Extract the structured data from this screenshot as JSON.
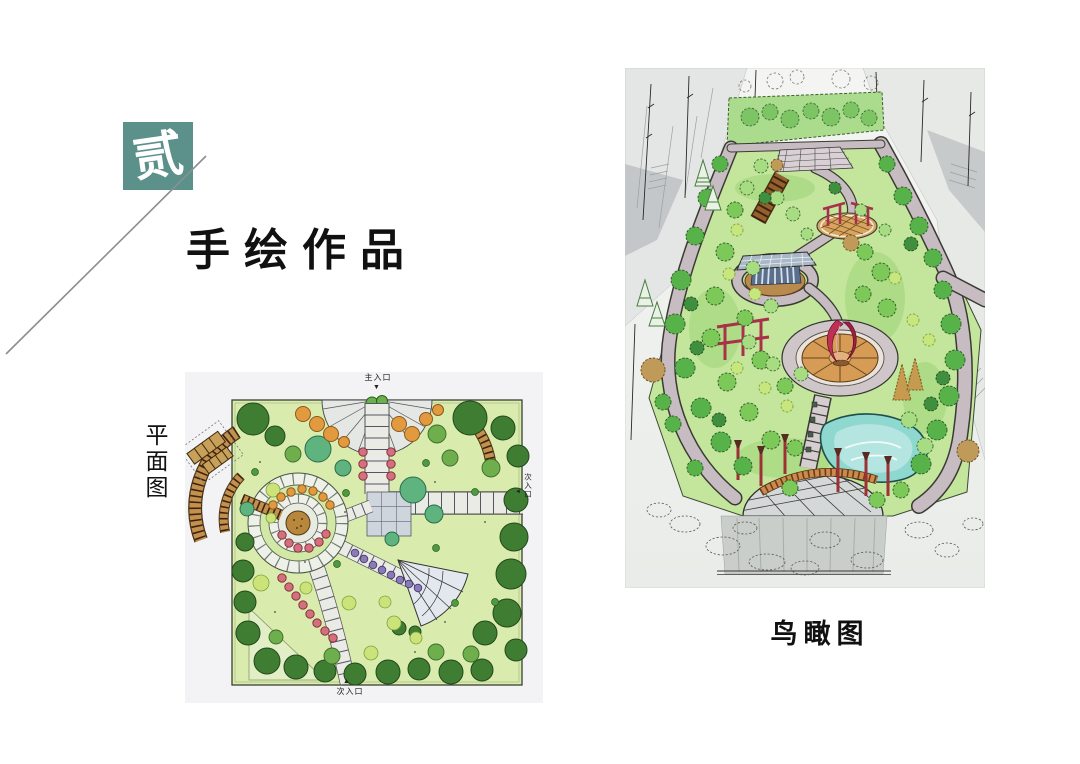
{
  "slide": {
    "background": "#ffffff"
  },
  "badge": {
    "number_char": "贰",
    "bg_color": "#5b918a",
    "fg_color": "#ffffff"
  },
  "divider": {
    "color": "#8a8f8f"
  },
  "title": {
    "text": "手绘作品",
    "color": "#111111"
  },
  "plan": {
    "caption": "平面图",
    "entrance_labels": {
      "main": "主入口",
      "right": "次入口",
      "bottom": "次入口"
    },
    "arrows": {
      "down": "▼",
      "left": "◄",
      "up": "▲"
    },
    "palette": {
      "paper": "#f3f3f5",
      "lawn": "#d9ecae",
      "tree_dark": "#3f7d33",
      "tree_teal": "#5fb37f",
      "shrub_orange": "#e39a3f",
      "shrub_pink": "#d4707e",
      "shrub_purple": "#8a7ab8",
      "path": "#e9ebe4",
      "wood_pergola": "#c4904d",
      "center_mulch": "#b6873d"
    }
  },
  "aerial": {
    "caption": "鸟瞰图",
    "palette": {
      "paper": "#eef0ec",
      "lawn": "#c3e59c",
      "path": "#c6bcc1",
      "pool": "#8ed8d0",
      "deck_wood": "#d69c55",
      "sculpture_red": "#b5274d",
      "pergola_red": "#a8304a",
      "building_gray": "#e4e6e5",
      "hedge_green": "#abdc8e",
      "roof_blue": "#a9b8c6"
    }
  }
}
